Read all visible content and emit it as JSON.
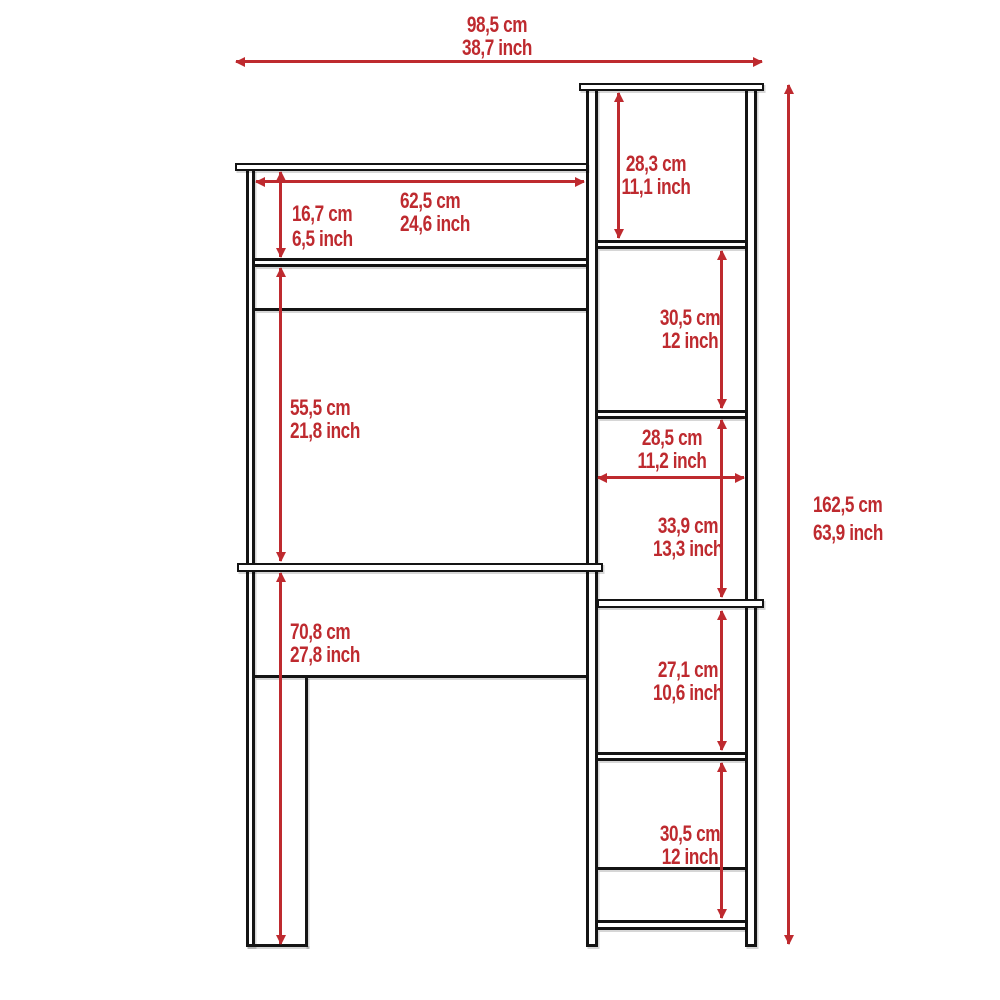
{
  "diagram": {
    "kind": "furniture-dimension-drawing",
    "units": [
      "cm",
      "inch"
    ]
  },
  "colors": {
    "dimension_red": "#BE2A2F",
    "outline_black": "#141414",
    "background": "#FFFFFF"
  },
  "dims": {
    "overall_width": {
      "cm": "98,5 cm",
      "inch": "38,7 inch"
    },
    "overall_height": {
      "cm": "162,5 cm",
      "inch": "63,9 inch"
    },
    "hutch_width": {
      "cm": "62,5 cm",
      "inch": "24,6 inch"
    },
    "hutch_opening": {
      "cm": "16,7 cm",
      "inch": "6,5 inch"
    },
    "desk_clearance": {
      "cm": "55,5 cm",
      "inch": "21,8 inch"
    },
    "floor_to_desktop": {
      "cm": "70,8 cm",
      "inch": "27,8 inch"
    },
    "cubby_1": {
      "cm": "28,3 cm",
      "inch": "11,1 inch"
    },
    "cubby_2": {
      "cm": "30,5 cm",
      "inch": "12 inch"
    },
    "cubby_width": {
      "cm": "28,5 cm",
      "inch": "11,2 inch"
    },
    "cubby_3": {
      "cm": "33,9 cm",
      "inch": "13,3 inch"
    },
    "cubby_4": {
      "cm": "27,1 cm",
      "inch": "10,6 inch"
    },
    "cubby_5": {
      "cm": "30,5 cm",
      "inch": "12 inch"
    }
  }
}
